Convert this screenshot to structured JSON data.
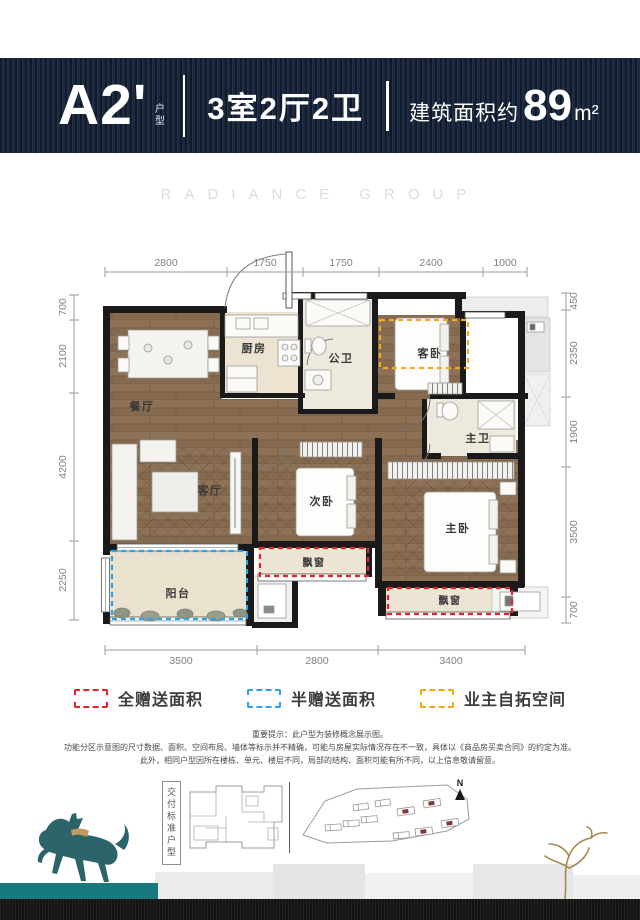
{
  "header": {
    "unit_code": "A2'",
    "unit_type_label": "户型",
    "layout": "3室2厅2卫",
    "area_prefix": "建筑面积约",
    "area_value": "89",
    "area_unit": "m²"
  },
  "watermark": "RADIANCE GROUP",
  "floorplan": {
    "rooms": {
      "dining": "餐厅",
      "kitchen": "厨房",
      "public_bath": "公卫",
      "guest_bedroom": "客卧",
      "master_bath": "主卫",
      "living": "客厅",
      "second_bedroom": "次卧",
      "master_bedroom": "主卧",
      "balcony": "阳台",
      "bay_window": "飘窗"
    },
    "dimensions": {
      "top": [
        "2800",
        "1750",
        "1750",
        "2400",
        "1000"
      ],
      "left": [
        "700",
        "2100",
        "4200",
        "2250"
      ],
      "right": [
        "450",
        "2350",
        "1900",
        "3500",
        "700"
      ],
      "bottom": [
        "3500",
        "2800",
        "3400"
      ]
    }
  },
  "legend": {
    "items": [
      {
        "label": "全赠送面积",
        "color": "#e52328"
      },
      {
        "label": "半赠送面积",
        "color": "#2aa2f2"
      },
      {
        "label": "业主自拓空间",
        "color": "#f6a81c"
      }
    ]
  },
  "disclaimer": {
    "line1": "重要提示：此户型为装修概念展示图。",
    "line2": "功能分区示意图的尺寸数据、面积、空间布局、墙体等标示并不精确，可能与房屋实际情况存在不一致，具体以《商品房买卖合同》的约定为准。",
    "line3": "此外，相同户型因所在楼栋、单元、楼层不同，局部的结构、面积可能有所不同，以上信息敬请留意。"
  },
  "footer": {
    "standard_label": "交付标准户型",
    "north_label": "N"
  },
  "colors": {
    "header_navy": "#1b2940",
    "wall_black": "#1a1a1a",
    "wood_floor": "#8c7158",
    "accent_red": "#e52328",
    "accent_blue": "#2aa2f2",
    "accent_orange": "#f6a81c",
    "teal_band": "#177a7f"
  }
}
